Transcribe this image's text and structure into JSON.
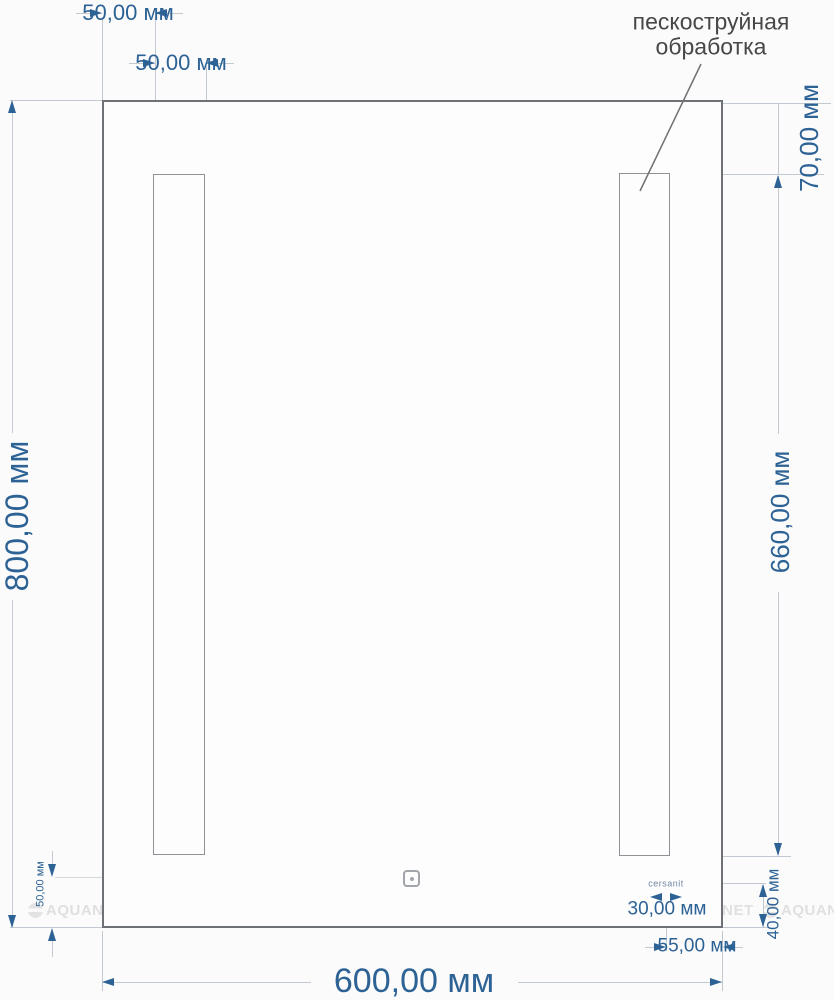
{
  "annotation": {
    "line1": "пескоструйная",
    "line2": "обработка"
  },
  "brand_logo": "cersanit",
  "watermark": {
    "text": "AQUANET"
  },
  "dimensions": {
    "mirror_width": "600,00 мм",
    "mirror_height": "800,00 мм",
    "strip_left_offset": "50,00 мм",
    "strip_width": "50,00 мм",
    "strip_top_offset": "70,00 мм",
    "strip_height": "660,00 мм",
    "sensor_bottom_offset": "50,00 мм",
    "logo_width": "30,00 мм",
    "logo_right_offset": "55,00 мм",
    "logo_bottom_offset": "40,00 мм"
  },
  "colors": {
    "dimension_blue": "#2d6295",
    "thin_line_gray": "#c2c9d1",
    "mirror_outline": "#6e7276",
    "annotation_dark": "#474747",
    "brand_blue": "#7187a6",
    "watermark_gray": "#e0e0e0"
  }
}
